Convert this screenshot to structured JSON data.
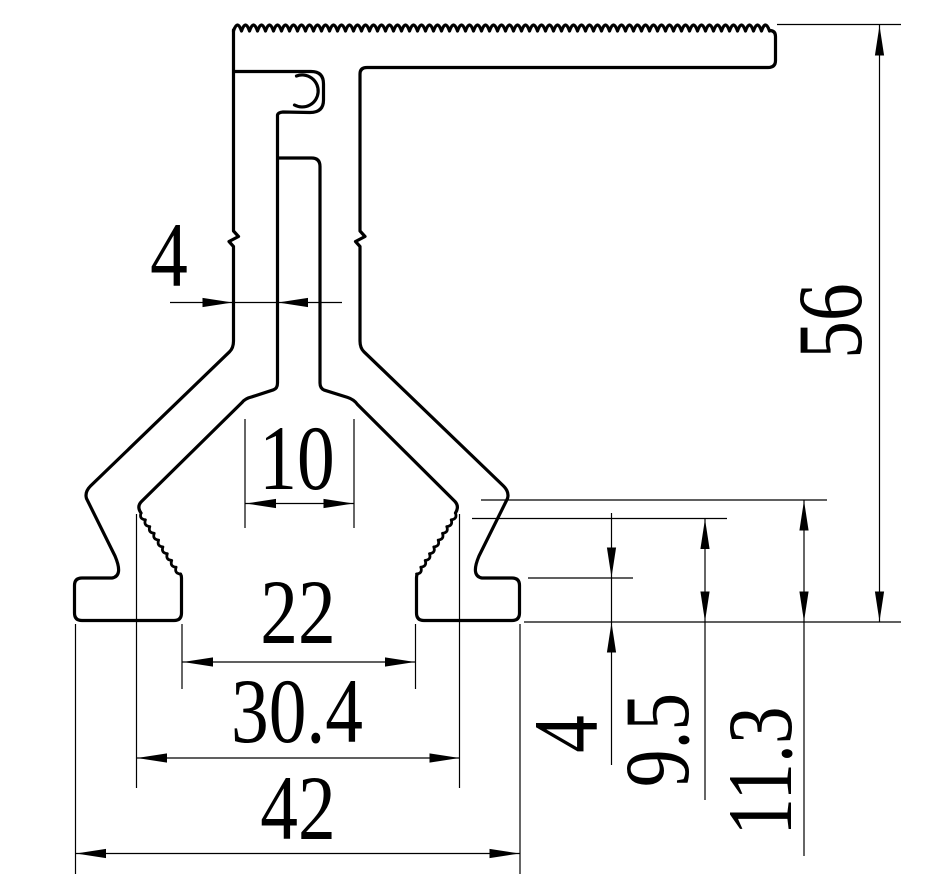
{
  "drawing": {
    "kind": "extrusion-profile-cross-section",
    "units": "mm",
    "background_color": "#ffffff",
    "line_color": "#000000"
  },
  "dimensions": {
    "slot_width": {
      "label": "4",
      "value": 4,
      "orientation": "horizontal"
    },
    "mouth_width": {
      "label": "10",
      "value": 10,
      "orientation": "horizontal"
    },
    "channel_opening": {
      "label": "22",
      "value": 22,
      "orientation": "horizontal"
    },
    "channel_max_width": {
      "label": "30.4",
      "value": 30.4,
      "orientation": "horizontal"
    },
    "base_width": {
      "label": "42",
      "value": 42,
      "orientation": "horizontal"
    },
    "overall_height": {
      "label": "56",
      "value": 56,
      "orientation": "vertical"
    },
    "foot_height": {
      "label": "4",
      "value": 4,
      "orientation": "vertical"
    },
    "ledge_height": {
      "label": "9.5",
      "value": 9.5,
      "orientation": "vertical"
    },
    "knee_height": {
      "label": "11.3",
      "value": 11.3,
      "orientation": "vertical"
    }
  }
}
